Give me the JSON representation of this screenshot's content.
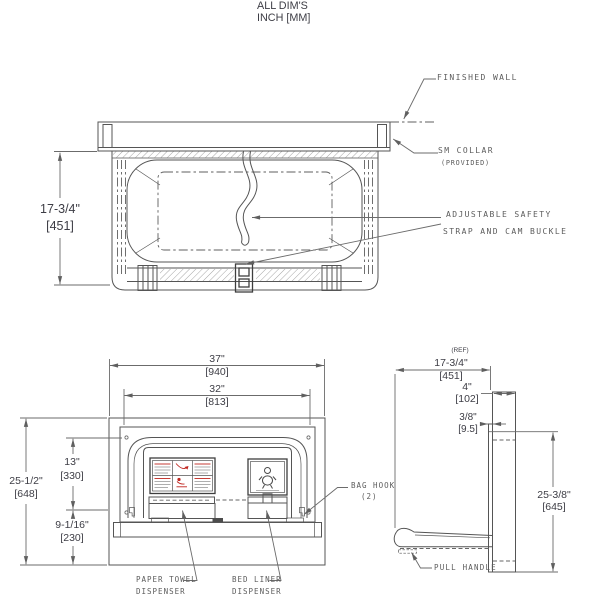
{
  "title_note": {
    "line1": "ALL DIM'S",
    "line2": "INCH [MM]"
  },
  "top_view": {
    "callouts": {
      "finished_wall": "FINISHED WALL",
      "sm_collar": "SM COLLAR",
      "sm_collar_note": "(PROVIDED)",
      "safety_strap_line1": "ADJUSTABLE SAFETY",
      "safety_strap_line2": "STRAP AND CAM BUCKLE"
    },
    "dims": {
      "open_depth_in": "17-3/4\"",
      "open_depth_mm": "[451]"
    }
  },
  "front_view": {
    "dims": {
      "overall_width_in": "37\"",
      "overall_width_mm": "[940]",
      "door_width_in": "32\"",
      "door_width_mm": "[813]",
      "overall_height_in": "25-1/2\"",
      "overall_height_mm": "[648]",
      "upper_height_in": "13\"",
      "upper_height_mm": "[330]",
      "lower_height_in": "9-1/16\"",
      "lower_height_mm": "[230]"
    },
    "callouts": {
      "paper_towel_line1": "PAPER TOWEL",
      "paper_towel_line2": "DISPENSER",
      "bed_liner_line1": "BED LINER",
      "bed_liner_line2": "DISPENSER",
      "bag_hook_line1": "BAG HOOK",
      "bag_hook_line2": "(2)"
    }
  },
  "side_view": {
    "dims": {
      "ref_note": "(REF)",
      "open_depth_in": "17-3/4\"",
      "open_depth_mm": "[451]",
      "recess_depth_in": "4\"",
      "recess_depth_mm": "[102]",
      "flange_in": "3/8\"",
      "flange_mm": "[9.5]",
      "panel_height_in": "25-3/8\"",
      "panel_height_mm": "[645]"
    },
    "callouts": {
      "pull_handle": "PULL HANDLE"
    }
  },
  "colors": {
    "line": "#555555",
    "dimension_text": "#3d3d45",
    "callout_text": "#5c5c5c",
    "accent_red": "#c0251f",
    "background": "#ffffff"
  }
}
